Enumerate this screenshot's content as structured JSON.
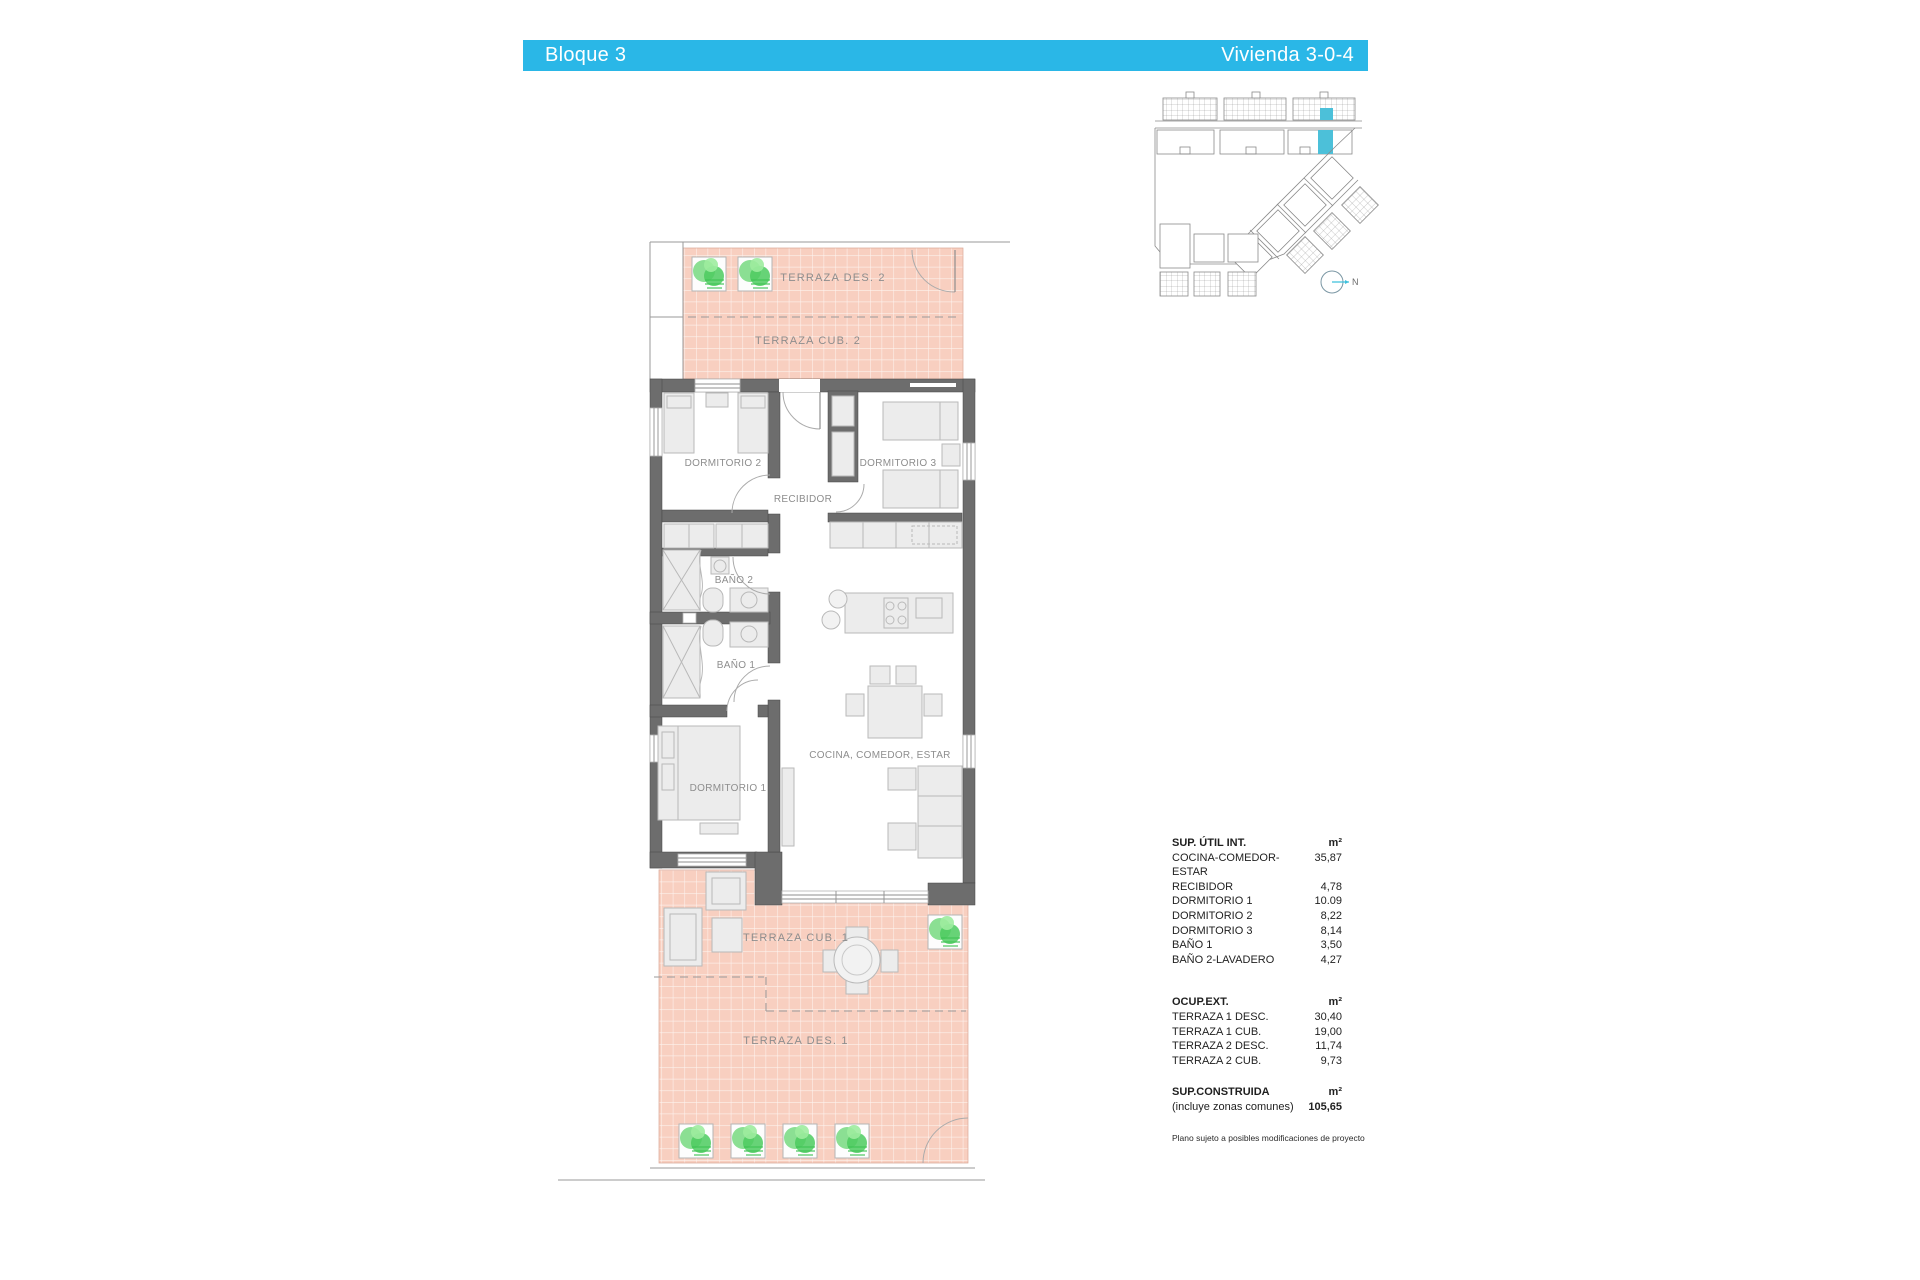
{
  "header": {
    "left_title": "Bloque 3",
    "right_title": "Vivienda 3-0-4"
  },
  "floorplan": {
    "labels": {
      "terraza_des_2": "TERRAZA DES. 2",
      "terraza_cub_2": "TERRAZA CUB. 2",
      "dormitorio_2": "DORMITORIO 2",
      "dormitorio_3": "DORMITORIO 3",
      "recibidor": "RECIBIDOR",
      "bano_2": "BAÑO 2",
      "bano_1": "BAÑO 1",
      "dormitorio_1": "DORMITORIO 1",
      "cocina_comedor_estar": "COCINA, COMEDOR, ESTAR",
      "terraza_cub_1": "TERRAZA CUB. 1",
      "terraza_des_1": "TERRAZA DES. 1"
    }
  },
  "site_plan": {
    "north_label": "N"
  },
  "area_table": {
    "util": {
      "title": "SUP. ÚTIL INT.",
      "unit": "m²",
      "rows": [
        {
          "label": "COCINA-COMEDOR-ESTAR",
          "value": "35,87"
        },
        {
          "label": "RECIBIDOR",
          "value": "4,78"
        },
        {
          "label": "DORMITORIO 1",
          "value": "10.09"
        },
        {
          "label": "DORMITORIO 2",
          "value": "8,22"
        },
        {
          "label": "DORMITORIO 3",
          "value": "8,14"
        },
        {
          "label": "BAÑO 1",
          "value": "3,50"
        },
        {
          "label": "BAÑO 2-LAVADERO",
          "value": "4,27"
        }
      ]
    },
    "ext": {
      "title": "OCUP.EXT.",
      "unit": "m²",
      "rows": [
        {
          "label": "TERRAZA 1 DESC.",
          "value": "30,40"
        },
        {
          "label": "TERRAZA 1 CUB.",
          "value": "19,00"
        },
        {
          "label": "TERRAZA 2 DESC.",
          "value": "11,74"
        },
        {
          "label": "TERRAZA 2 CUB.",
          "value": "9,73"
        }
      ]
    },
    "built": {
      "title": "SUP.CONSTRUIDA",
      "unit": "m²",
      "subtitle": "(incluye zonas comunes)",
      "value": "105,65"
    },
    "footnote": "Plano sujeto a posibles modificaciones de proyecto"
  },
  "colors": {
    "accent": "#2ab7e7",
    "terrace_fill": "#f8cfc0",
    "wall": "#6d6d6d",
    "plant_green": "#57d06a",
    "site_highlight": "#4cc0d9"
  }
}
